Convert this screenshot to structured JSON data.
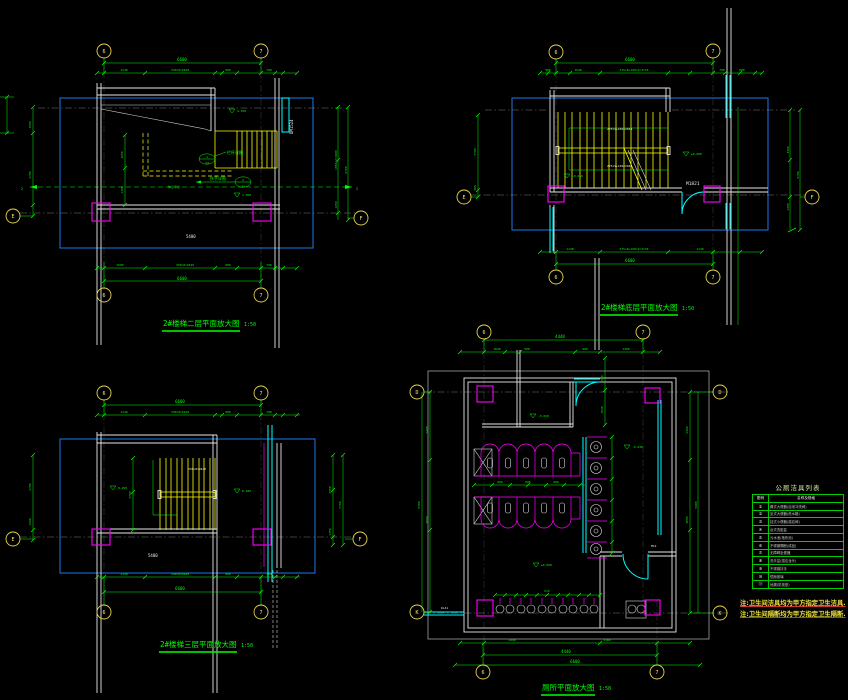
{
  "app": {
    "type": "CAD drawing sheet",
    "bg": "#000000"
  },
  "colors": {
    "green": "#00ff00",
    "yellow": "#ffff00",
    "cyan": "#00ffff",
    "magenta": "#ff00ff",
    "white": "#e8e8e8",
    "blue": "#1b6fd6",
    "axis_bubble": "#e8d44d"
  },
  "axis": {
    "c1": "6",
    "c2": "7",
    "rE": "E",
    "rF": "F",
    "rD": "D",
    "rK": "K"
  },
  "plans": {
    "top_left": {
      "title": "2#楼梯二层平面放大图",
      "scale": "1:50",
      "window_label": "DM1524",
      "room_label": "5400",
      "section_mark": "2",
      "levels": {
        "upper": "4.350",
        "mid": "1.050"
      },
      "callout1": {
        "num": "1",
        "sheet": "24",
        "text": "栏杆详图"
      },
      "callout2": {
        "num": "2",
        "sheet": "24",
        "text": "扶手详图"
      },
      "platform": "休息平台",
      "dims": {
        "overall": "6600",
        "t1": "1140",
        "t2": "330×8=2640",
        "t3": "900",
        "t4": "760",
        "b1": "1500",
        "b2": "330×8=2640",
        "b3": "900",
        "b4": "760",
        "l1": "1500",
        "l2": "2700",
        "r1": "1650×2=3300",
        "r2": "1350",
        "r3": "5700",
        "i1": "1650",
        "i2": "1100"
      }
    },
    "top_right": {
      "title": "2#楼梯底层平面放大图",
      "scale": "1:50",
      "door_label": "M1821",
      "tread_note": "275×9+169=2644",
      "levels": {
        "entry": "±0.000",
        "pit": "-0.450"
      },
      "dims": {
        "overall": "6600",
        "t1": "900",
        "t2": "1640",
        "t3": "275×8+169×2=2718",
        "t4": "700",
        "t5": "800",
        "b1": "1140",
        "b2": "275×8+169×2=2718",
        "b3": "1140",
        "l1": "2700",
        "l2": "300",
        "r1": "3300",
        "r2": "1350",
        "r3": "5700"
      }
    },
    "bottom_left": {
      "title": "2#楼梯三层平面放大图",
      "scale": "1:50",
      "tread_note": "330×8=2640",
      "room_label": "5400",
      "levels": {
        "a": "8.250",
        "b": "8.100"
      },
      "dims": {
        "overall": "6600",
        "t1": "1140",
        "t2": "330×8=2640",
        "t3": "900",
        "t4": "760",
        "b1": "1140",
        "b2": "330×8=2640",
        "b3": "900",
        "b4": "760",
        "l1": "2700",
        "l2": "1200",
        "r1": "3300",
        "r2": "1350",
        "r3": "5700",
        "i1": "2700"
      }
    },
    "toilet": {
      "title": "厕所平面放大图",
      "scale": "1:50",
      "door_label": "M12",
      "pipe_label": "DL41",
      "levels": {
        "a": "-0.020",
        "b": "±0.000"
      },
      "dims": {
        "w_top": "4440",
        "t1": "1640",
        "t2": "500",
        "t3": "900",
        "t4": "1400",
        "w_bot": "4440",
        "b1": "1440",
        "b2": "3160",
        "b_all": "6600",
        "l1": "2400",
        "l2": "3000",
        "l_all": "5400",
        "r1": "2400",
        "r2": "3000",
        "r_all": "5400",
        "e1": "900",
        "e2": "1540",
        "s1": "600",
        "basin": "615"
      }
    }
  },
  "legend": {
    "title": "公厕洁具列表",
    "header": {
      "sym": "图例",
      "name": "名称及规格"
    },
    "rows": [
      {
        "sym": "①",
        "name": "蹲式大便器(自闭冲洗阀)"
      },
      {
        "sym": "②",
        "name": "坐式大便器(低水箱)"
      },
      {
        "sym": "③",
        "name": "挂式小便器(感应阀)"
      },
      {
        "sym": "④",
        "name": "台式洗脸盆"
      },
      {
        "sym": "⑤",
        "name": "污水池(拖布池)"
      },
      {
        "sym": "⑥",
        "name": "不锈钢隔断(成品)"
      },
      {
        "sym": "⑦",
        "name": "无障碍坐便器"
      },
      {
        "sym": "⑧",
        "name": "洗手盆(感应龙头)"
      },
      {
        "sym": "⑨",
        "name": "不锈钢扶手"
      },
      {
        "sym": "⑩",
        "name": "镜面玻璃"
      },
      {
        "sym": "⑪",
        "name": "地漏(防臭型)"
      }
    ]
  },
  "notes": {
    "line1": "注:卫生间洁具均为甲方指定卫生洁具.",
    "line2": "注:卫生间隔断均为甲方指定卫生隔断."
  }
}
